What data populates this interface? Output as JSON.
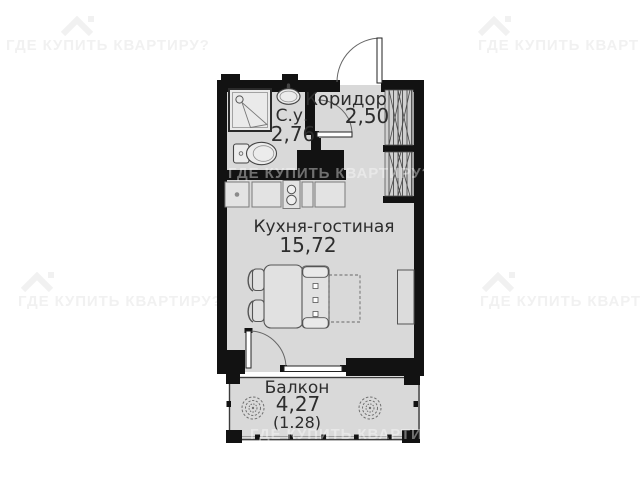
{
  "watermark": {
    "text": "ГДЕ КУПИТЬ КВАРТИРУ?"
  },
  "rooms": [
    {
      "name": "С.у.",
      "area": "2,76"
    },
    {
      "name": "Коридор",
      "area": "2,50"
    },
    {
      "name": "Кухня-гостиная",
      "area": "15,72"
    },
    {
      "name": "Балкон",
      "area": "4,27",
      "area_secondary": "(1.28)"
    }
  ],
  "fixtures": {
    "shower": "shower-icon",
    "bathroom_sink": "bathroom-sink-icon",
    "toilet": "toilet-icon",
    "kitchen_sink": "kitchen-sink-icon",
    "stove": "stove-icon",
    "wardrobe": "wardrobe-hatch-icon",
    "dining_table": "dining-table-icon",
    "chair": "chair-icon",
    "sofa_bed": "sofa-bed-icon",
    "tv_stand": "tv-stand-icon",
    "plant": "plant-icon",
    "house_logo": "house-icon"
  },
  "colors": {
    "wall": "#121212",
    "floor": "#d9d9d9",
    "fixture_fill": "#ececec",
    "watermark_on_white": "#f1f1f1",
    "watermark_on_plan": "rgba(255,255,255,0.40)"
  }
}
